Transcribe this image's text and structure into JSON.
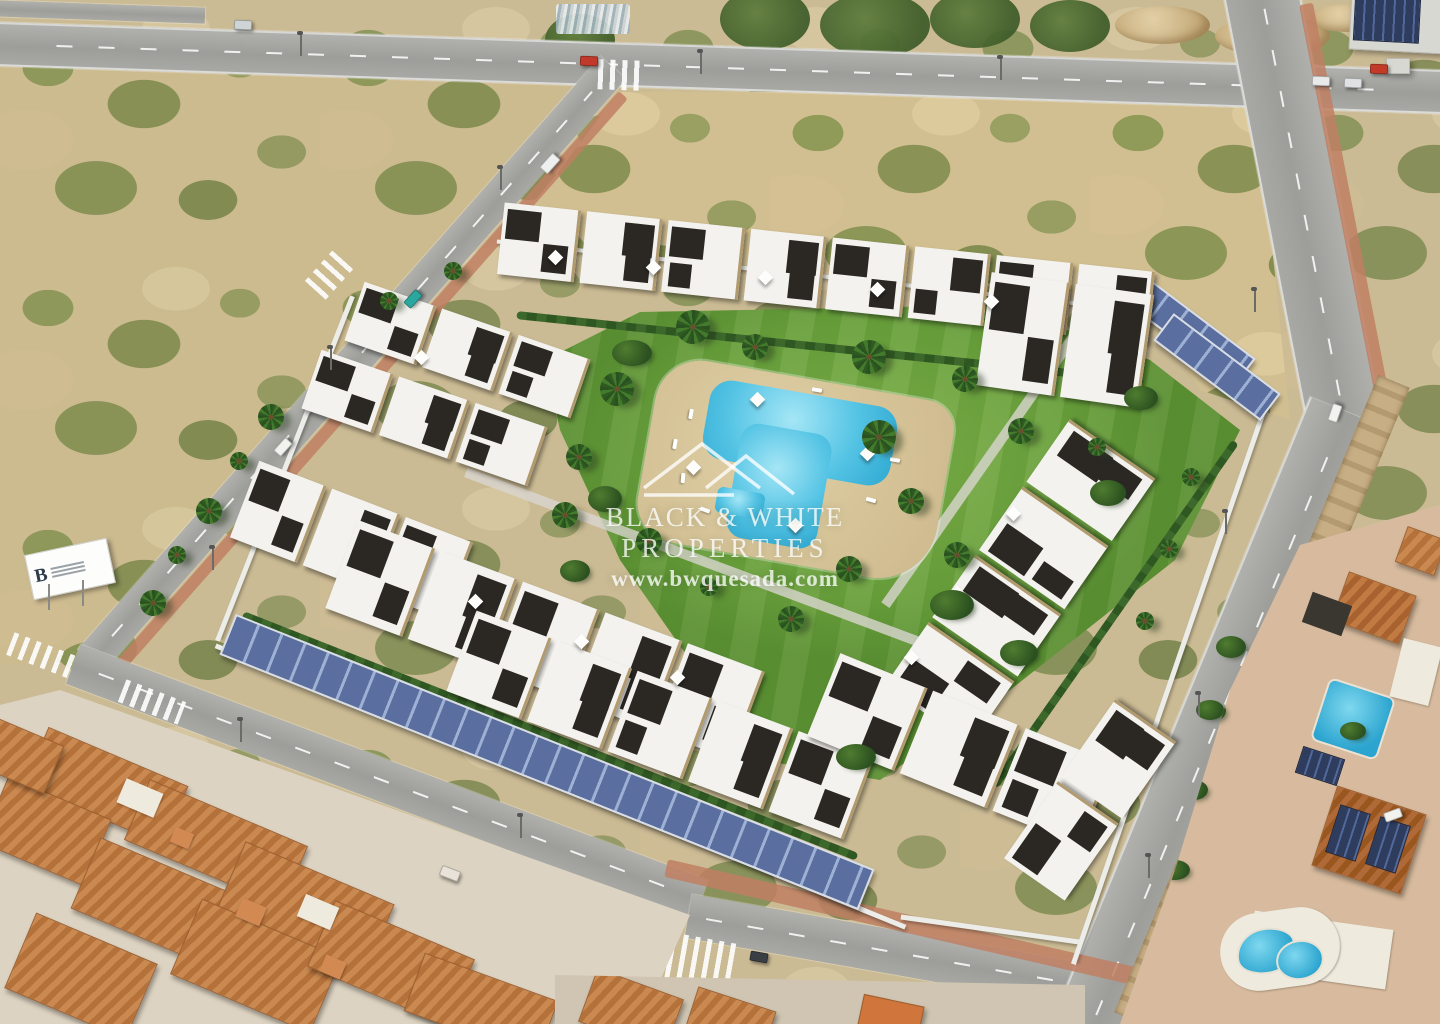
{
  "watermark": {
    "logo_icon": "double-roof-outline-icon",
    "line1": "BLACK & WHITE",
    "line2": "PROPERTIES",
    "line3": "www.bwquesada.com"
  },
  "billboard": {
    "letter": "B"
  },
  "colors": {
    "sand": "#cbbb94",
    "scrub_green": "#7c8a4d",
    "road": "#a7a7a3",
    "lawn": "#74a83e",
    "pool_water": "#55c4e4",
    "pool_deck": "#d8c69c",
    "building_white": "#f3f2ee",
    "building_dark": "#2b2824",
    "stone": "#b29a6f",
    "solar_panel": "#5a6f9f",
    "solar_panel_light": "#9db1d4",
    "wall_white": "#ecece8",
    "path_red": "#c07f63",
    "roof_terracotta": "#bd7a40",
    "watermark": "rgba(255,255,255,0.78)"
  }
}
